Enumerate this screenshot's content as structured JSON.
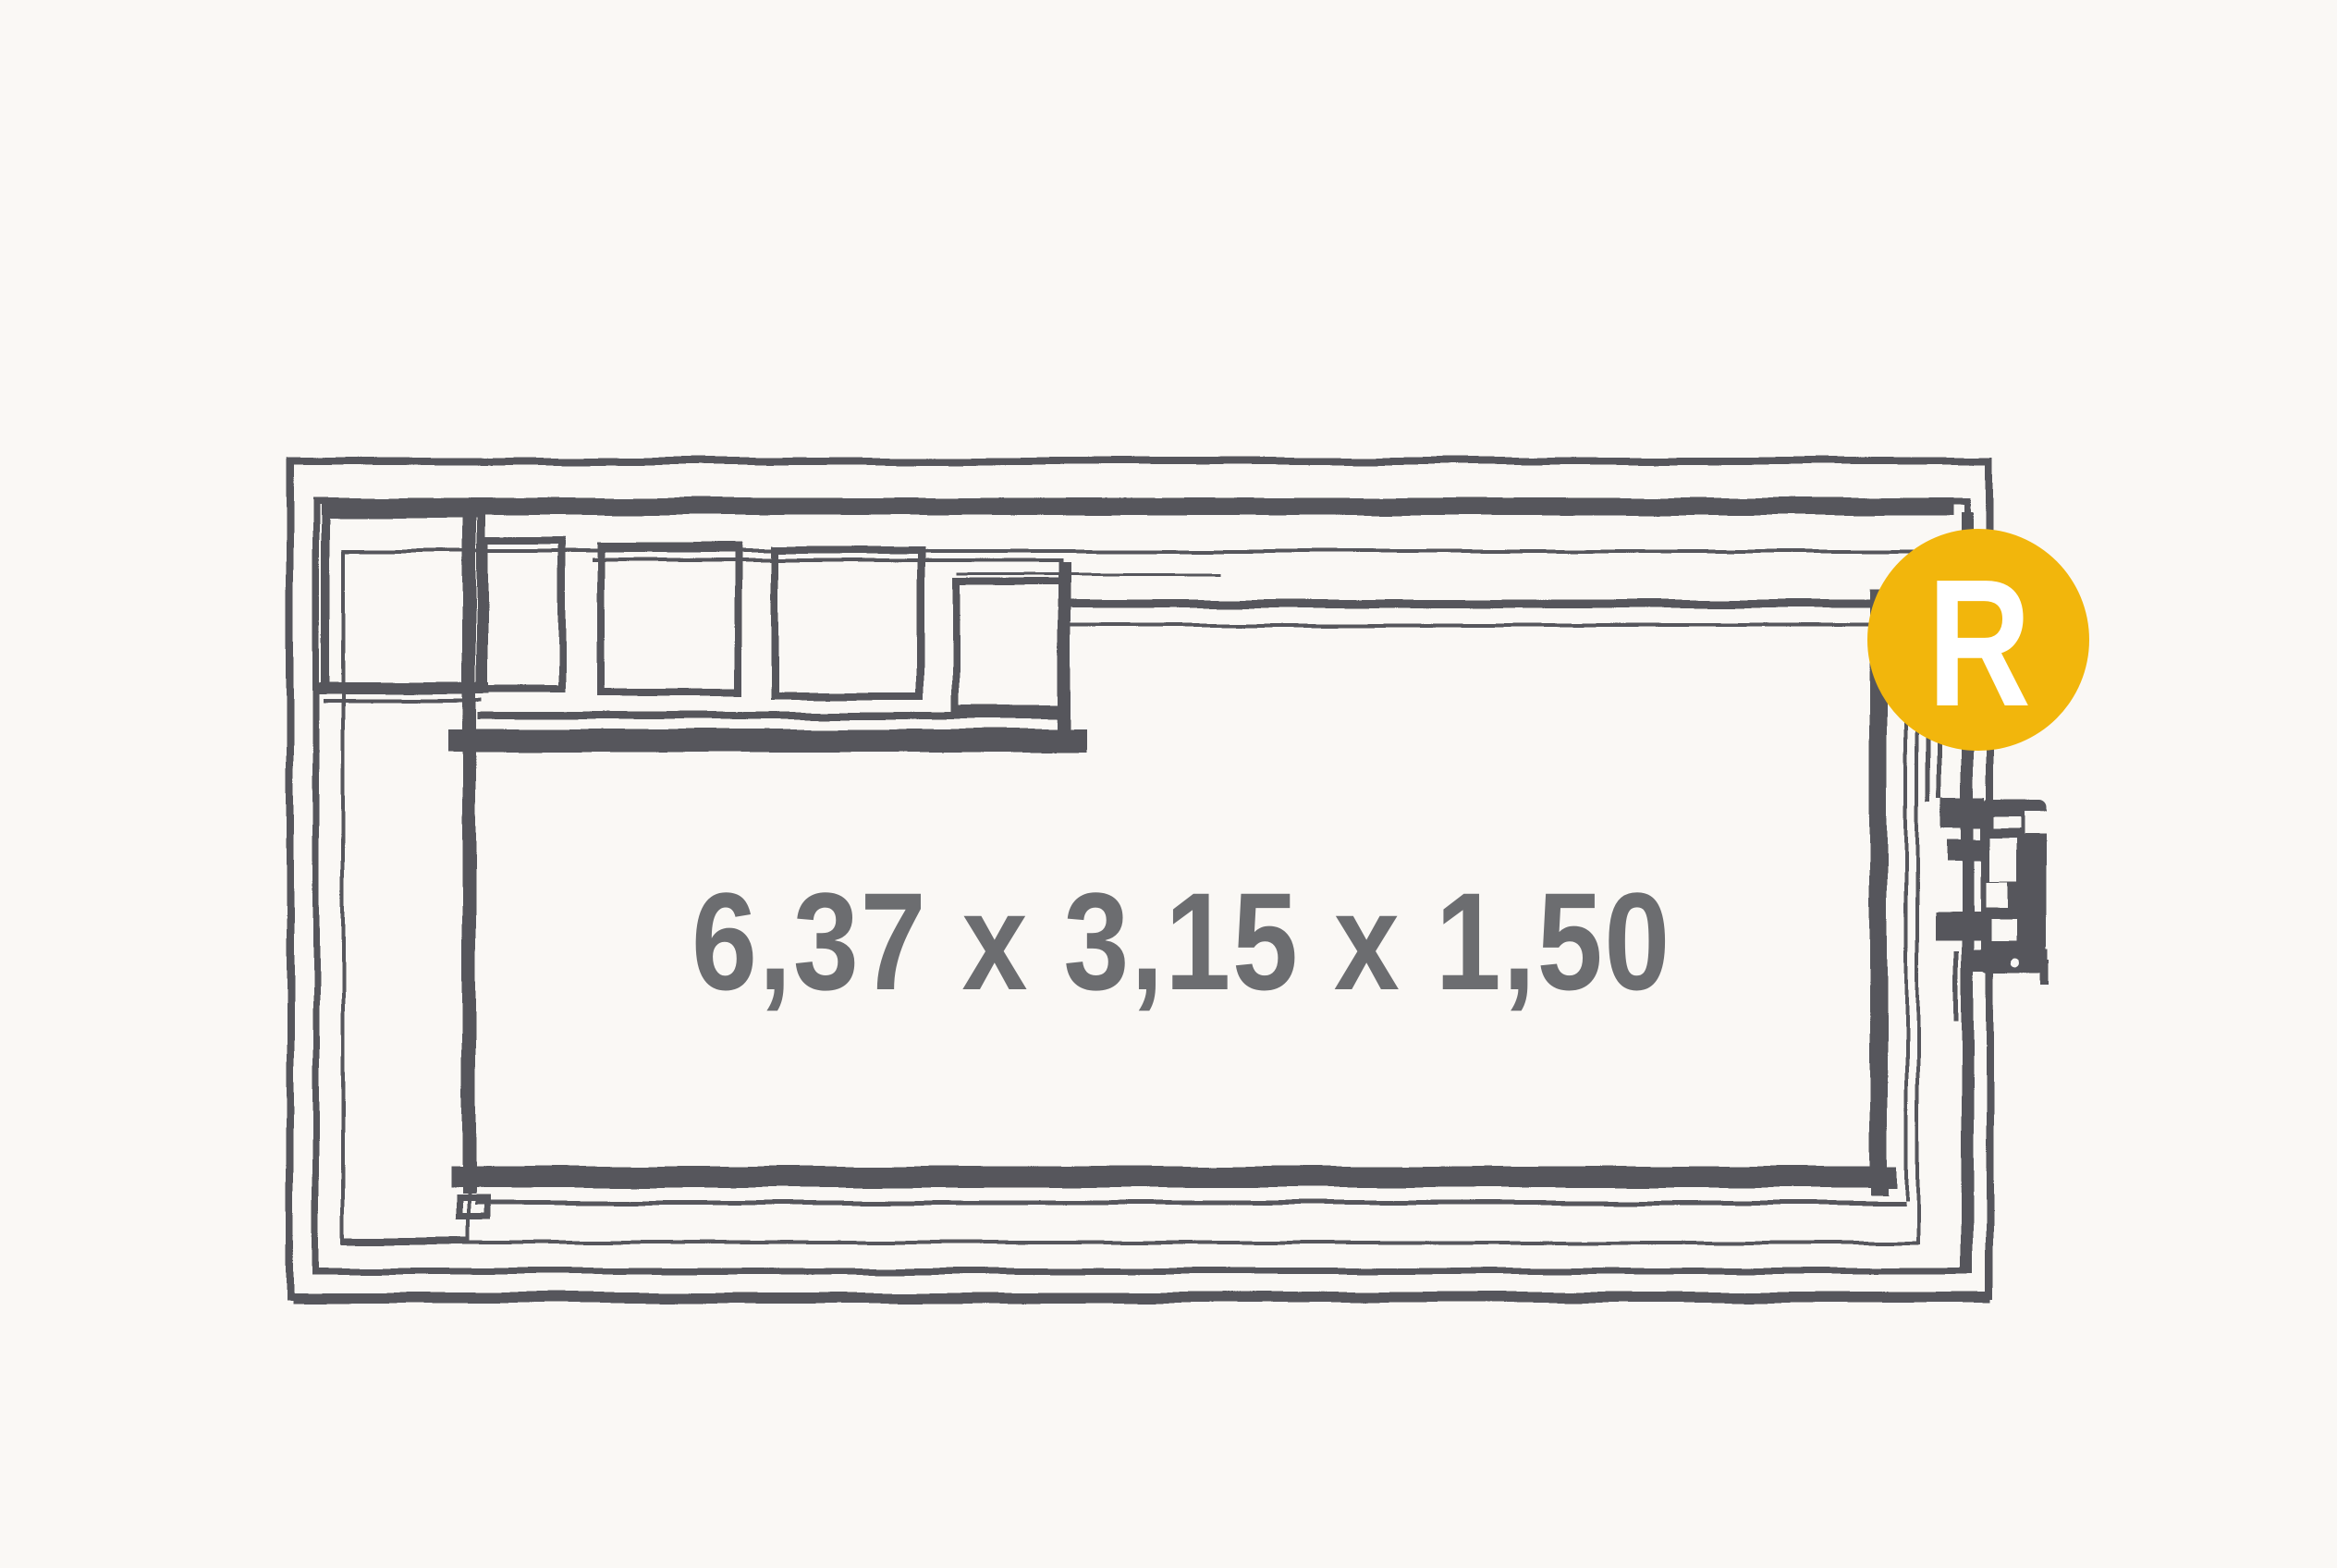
{
  "page": {
    "background": "#faf8f5"
  },
  "drawing": {
    "type": "swimming-pool-plan-top-view",
    "style": "hand-sketched technical line drawing",
    "dimensions_label": "6,37 x 3,15 x 1,50",
    "line_color": "#56575b",
    "label_color": "#6c6d70",
    "features": [
      "outer-shell-double-outline",
      "inner-waterline-outline",
      "corner-entry-steps",
      "side-bench-left",
      "skimmer-unit-right-wall"
    ]
  },
  "badge": {
    "letter": "R",
    "background": "#f2b60c",
    "letter_color": "#ffffff"
  }
}
